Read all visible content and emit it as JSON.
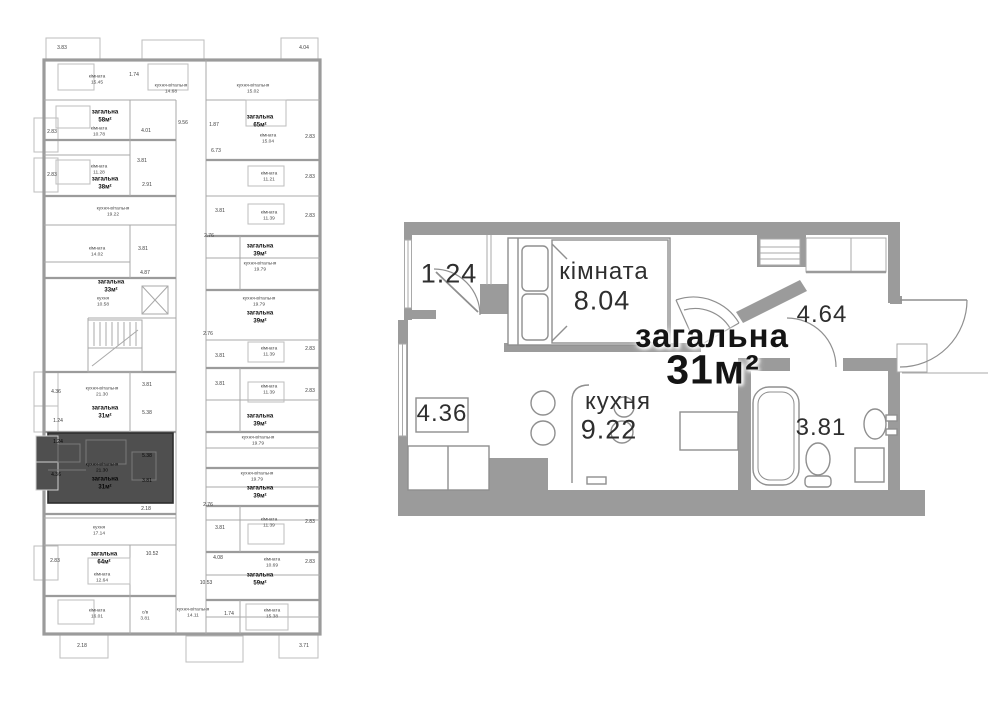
{
  "colors": {
    "wall": "#9b9b9b",
    "thin_line": "#a9a9a9",
    "furniture_line": "#8f8f8f",
    "highlight_fill": "#4f4f4f",
    "text": "#2e2e2e",
    "background": "#ffffff"
  },
  "left_plan": {
    "labels": [
      {
        "text": "3.83",
        "x": 62,
        "y": 49,
        "style": "dim"
      },
      {
        "text": "4.04",
        "x": 304,
        "y": 49,
        "style": "dim"
      },
      {
        "text": "кімната\n15.45",
        "x": 97,
        "y": 80,
        "style": "room"
      },
      {
        "text": "1.74",
        "x": 134,
        "y": 76,
        "style": "dim"
      },
      {
        "text": "кухня-вітальня\n14.68",
        "x": 171,
        "y": 89,
        "style": "room"
      },
      {
        "text": "кухня-вітальня\n15.02",
        "x": 253,
        "y": 89,
        "style": "room"
      },
      {
        "text": "загальна\n58м²",
        "x": 105,
        "y": 117,
        "style": "unit"
      },
      {
        "text": "кімната\n10.78",
        "x": 99,
        "y": 132,
        "style": "room"
      },
      {
        "text": "4.01",
        "x": 146,
        "y": 132,
        "style": "dim"
      },
      {
        "text": "9.56",
        "x": 183,
        "y": 124,
        "style": "dim"
      },
      {
        "text": "1.87",
        "x": 214,
        "y": 126,
        "style": "dim"
      },
      {
        "text": "загальна\n65м²",
        "x": 260,
        "y": 122,
        "style": "unit"
      },
      {
        "text": "кімната\n15.04",
        "x": 268,
        "y": 139,
        "style": "room"
      },
      {
        "text": "2.83",
        "x": 52,
        "y": 133,
        "style": "dim"
      },
      {
        "text": "2.83",
        "x": 310,
        "y": 138,
        "style": "dim"
      },
      {
        "text": "6.73",
        "x": 216,
        "y": 152,
        "style": "dim"
      },
      {
        "text": "кімната\n11.28",
        "x": 99,
        "y": 170,
        "style": "room"
      },
      {
        "text": "3.81",
        "x": 142,
        "y": 162,
        "style": "dim"
      },
      {
        "text": "загальна\n38м²",
        "x": 105,
        "y": 184,
        "style": "unit"
      },
      {
        "text": "2.91",
        "x": 147,
        "y": 186,
        "style": "dim"
      },
      {
        "text": "2.83",
        "x": 52,
        "y": 176,
        "style": "dim"
      },
      {
        "text": "кімната\n11.21",
        "x": 269,
        "y": 177,
        "style": "room"
      },
      {
        "text": "2.83",
        "x": 310,
        "y": 178,
        "style": "dim"
      },
      {
        "text": "кухня-вітальня\n19.22",
        "x": 113,
        "y": 212,
        "style": "room"
      },
      {
        "text": "3.81",
        "x": 220,
        "y": 212,
        "style": "dim"
      },
      {
        "text": "кімната\n11.39",
        "x": 269,
        "y": 216,
        "style": "room"
      },
      {
        "text": "2.83",
        "x": 310,
        "y": 217,
        "style": "dim"
      },
      {
        "text": "2.76",
        "x": 209,
        "y": 237,
        "style": "dim"
      },
      {
        "text": "кімната\n14.02",
        "x": 97,
        "y": 252,
        "style": "room"
      },
      {
        "text": "3.81",
        "x": 143,
        "y": 250,
        "style": "dim"
      },
      {
        "text": "загальна\n39м²",
        "x": 260,
        "y": 251,
        "style": "unit"
      },
      {
        "text": "кухня-вітальня\n19.79",
        "x": 260,
        "y": 267,
        "style": "room"
      },
      {
        "text": "4.87",
        "x": 145,
        "y": 274,
        "style": "dim"
      },
      {
        "text": "загальна\n33м²",
        "x": 111,
        "y": 287,
        "style": "unit"
      },
      {
        "text": "кухня\n10.58",
        "x": 103,
        "y": 302,
        "style": "room"
      },
      {
        "text": "кухня-вітальня\n19.79",
        "x": 259,
        "y": 302,
        "style": "room"
      },
      {
        "text": "загальна\n39м²",
        "x": 260,
        "y": 318,
        "style": "unit"
      },
      {
        "text": "2.76",
        "x": 208,
        "y": 335,
        "style": "dim"
      },
      {
        "text": "кімната\n11.39",
        "x": 269,
        "y": 352,
        "style": "room"
      },
      {
        "text": "2.83",
        "x": 310,
        "y": 350,
        "style": "dim"
      },
      {
        "text": "3.81",
        "x": 220,
        "y": 357,
        "style": "dim"
      },
      {
        "text": "3.81",
        "x": 220,
        "y": 385,
        "style": "dim"
      },
      {
        "text": "кімната\n11.39",
        "x": 269,
        "y": 390,
        "style": "room"
      },
      {
        "text": "2.83",
        "x": 310,
        "y": 392,
        "style": "dim"
      },
      {
        "text": "4.36",
        "x": 56,
        "y": 393,
        "style": "dim"
      },
      {
        "text": "кухня-вітальня\n21.30",
        "x": 102,
        "y": 392,
        "style": "room"
      },
      {
        "text": "3.81",
        "x": 147,
        "y": 386,
        "style": "dim"
      },
      {
        "text": "загальна\n31м²",
        "x": 105,
        "y": 413,
        "style": "unit"
      },
      {
        "text": "5.38",
        "x": 147,
        "y": 414,
        "style": "dim"
      },
      {
        "text": "1.24",
        "x": 58,
        "y": 422,
        "style": "dim"
      },
      {
        "text": "загальна\n39м²",
        "x": 260,
        "y": 421,
        "style": "unit"
      },
      {
        "text": "кухня-вітальня\n19.79",
        "x": 258,
        "y": 441,
        "style": "room"
      },
      {
        "text": "1.24",
        "x": 58,
        "y": 443,
        "style": "dim dark"
      },
      {
        "text": "5.38",
        "x": 147,
        "y": 457,
        "style": "dim dark"
      },
      {
        "text": "кухня-вітальня\n21.30",
        "x": 102,
        "y": 468,
        "style": "room dark"
      },
      {
        "text": "4.36",
        "x": 56,
        "y": 476,
        "style": "dim dark"
      },
      {
        "text": "загальна\n31м²",
        "x": 105,
        "y": 484,
        "style": "unit dark"
      },
      {
        "text": "3.81",
        "x": 147,
        "y": 482,
        "style": "dim dark"
      },
      {
        "text": "кухня-вітальня\n19.79",
        "x": 257,
        "y": 477,
        "style": "room"
      },
      {
        "text": "загальна\n39м²",
        "x": 260,
        "y": 493,
        "style": "unit"
      },
      {
        "text": "2.76",
        "x": 208,
        "y": 506,
        "style": "dim"
      },
      {
        "text": "2.18",
        "x": 146,
        "y": 510,
        "style": "dim"
      },
      {
        "text": "кімната\n11.39",
        "x": 269,
        "y": 523,
        "style": "room"
      },
      {
        "text": "2.83",
        "x": 310,
        "y": 523,
        "style": "dim"
      },
      {
        "text": "3.81",
        "x": 220,
        "y": 529,
        "style": "dim"
      },
      {
        "text": "кухня\n17.14",
        "x": 99,
        "y": 531,
        "style": "room"
      },
      {
        "text": "10.52",
        "x": 152,
        "y": 555,
        "style": "dim"
      },
      {
        "text": "2.83",
        "x": 55,
        "y": 562,
        "style": "dim"
      },
      {
        "text": "загальна\n64м²",
        "x": 104,
        "y": 559,
        "style": "unit"
      },
      {
        "text": "кімната\n12.64",
        "x": 102,
        "y": 578,
        "style": "room"
      },
      {
        "text": "4.08",
        "x": 218,
        "y": 559,
        "style": "dim"
      },
      {
        "text": "кімната\n10.69",
        "x": 272,
        "y": 563,
        "style": "room"
      },
      {
        "text": "2.83",
        "x": 310,
        "y": 563,
        "style": "dim"
      },
      {
        "text": "загальна\n59м²",
        "x": 260,
        "y": 580,
        "style": "unit"
      },
      {
        "text": "10.53",
        "x": 206,
        "y": 584,
        "style": "dim"
      },
      {
        "text": "кімната\n16.01",
        "x": 97,
        "y": 614,
        "style": "room"
      },
      {
        "text": "с/в\n3.81",
        "x": 145,
        "y": 616,
        "style": "room"
      },
      {
        "text": "кухня-вітальня\n14.11",
        "x": 193,
        "y": 613,
        "style": "room"
      },
      {
        "text": "1.74",
        "x": 229,
        "y": 615,
        "style": "dim"
      },
      {
        "text": "кімната\n15.38",
        "x": 272,
        "y": 614,
        "style": "room"
      },
      {
        "text": "2.18",
        "x": 82,
        "y": 647,
        "style": "dim"
      },
      {
        "text": "3.71",
        "x": 304,
        "y": 647,
        "style": "dim"
      }
    ]
  },
  "right_plan": {
    "labels": [
      {
        "text": "1.24",
        "x": 449,
        "y": 274,
        "style": "lg"
      },
      {
        "text": "кімната",
        "x": 604,
        "y": 272,
        "style": "md"
      },
      {
        "text": "8.04",
        "x": 602,
        "y": 301,
        "style": "lg"
      },
      {
        "text": "загальна",
        "x": 712,
        "y": 336,
        "style": "t1"
      },
      {
        "text": "31м²",
        "x": 713,
        "y": 370,
        "style": "t2"
      },
      {
        "text": "4.64",
        "x": 822,
        "y": 315,
        "style": "md"
      },
      {
        "text": "кухня",
        "x": 618,
        "y": 402,
        "style": "md"
      },
      {
        "text": "9.22",
        "x": 609,
        "y": 430,
        "style": "lg"
      },
      {
        "text": "4.36",
        "x": 442,
        "y": 414,
        "style": "md"
      },
      {
        "text": "3.81",
        "x": 821,
        "y": 428,
        "style": "md"
      }
    ]
  }
}
